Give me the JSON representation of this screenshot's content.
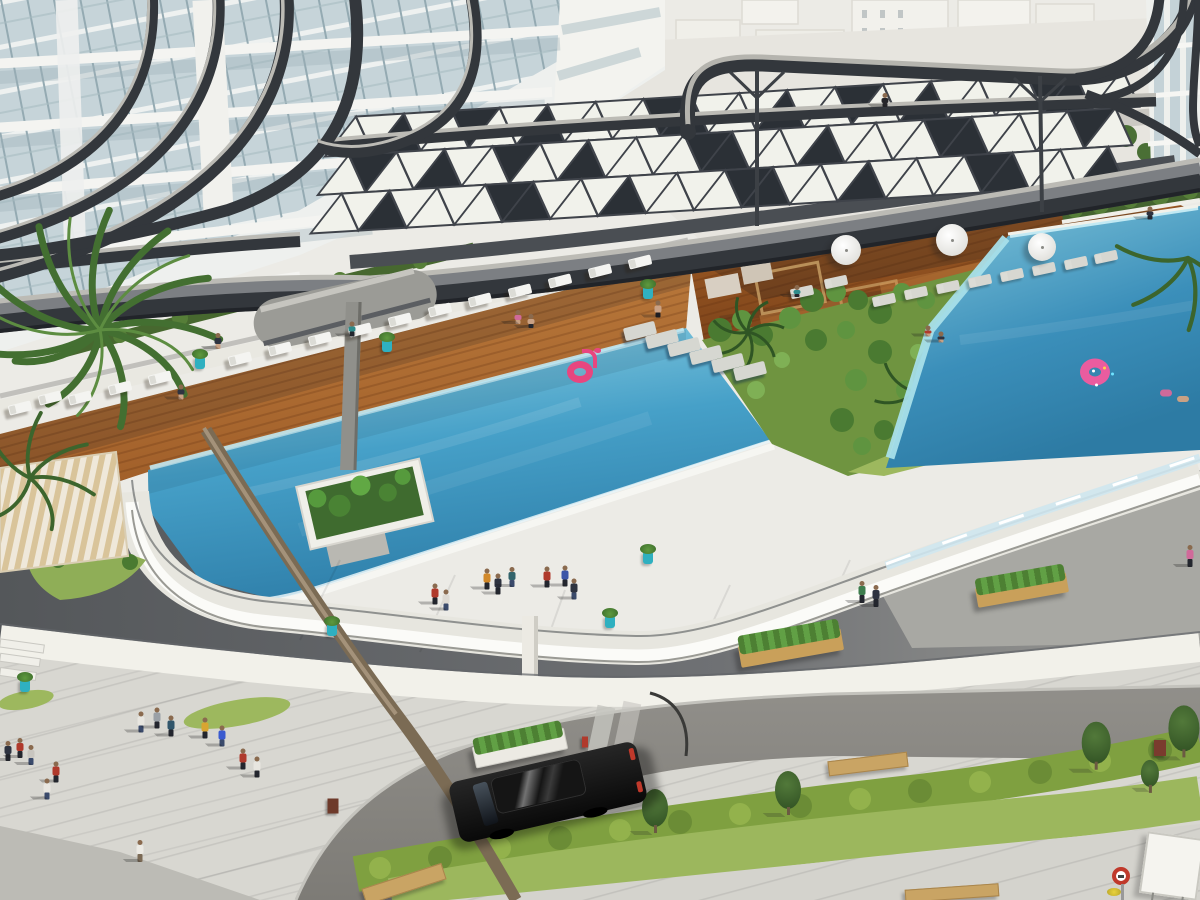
{
  "scene": {
    "name": "aerial-resort-pool-render",
    "width": 1200,
    "height": 900,
    "description": "3D architectural rendering, aerial view of residential complex with curved canopy, two pools, decks, plaza, street"
  },
  "palette": {
    "bg": "#ecebe6",
    "teal": "#2fb0c0",
    "pink": "#e8467f",
    "water-main": "#3f9ec7",
    "water-deep": "#2b7aa8",
    "water-shallow": "#9fdbe8",
    "fin-dark": "#33373c",
    "fin-light": "#bcbbb5",
    "panel-white": "#f1f2eb",
    "panel-dark": "#2b3036",
    "wood-deck": "#c08040",
    "wood-shade": "#8a4d20",
    "concrete": "#e9e8e1",
    "fascia": "#fbfbf8",
    "plaza-dark": "#54575a",
    "sidewalk": "#d8d7d1",
    "road": "#8e8c87",
    "hedge": "#7fa040",
    "grass": "#9cb75d",
    "palm": "#436f31",
    "trunk": "#7b6b54",
    "car": "#0a0a0a",
    "bench": "#c9a464",
    "sign-red": "#c0392b"
  },
  "canopy_field": {
    "cols": 17,
    "rows": 3,
    "cell_w": 48,
    "cell_h": 38,
    "dark": [
      [
        1,
        0,
        0
      ],
      [
        2,
        0,
        1
      ],
      [
        4,
        0,
        0
      ],
      [
        6,
        0,
        1
      ],
      [
        7,
        0,
        0
      ],
      [
        9,
        0,
        0
      ],
      [
        10,
        0,
        1
      ],
      [
        12,
        0,
        0
      ],
      [
        14,
        0,
        1
      ],
      [
        15,
        0,
        0
      ],
      [
        0,
        1,
        1
      ],
      [
        2,
        1,
        0
      ],
      [
        3,
        1,
        1
      ],
      [
        5,
        1,
        0
      ],
      [
        7,
        1,
        1
      ],
      [
        8,
        1,
        0
      ],
      [
        10,
        1,
        0
      ],
      [
        12,
        1,
        1
      ],
      [
        13,
        1,
        0
      ],
      [
        15,
        1,
        1
      ],
      [
        1,
        2,
        0
      ],
      [
        3,
        2,
        1
      ],
      [
        4,
        2,
        0
      ],
      [
        6,
        2,
        0
      ],
      [
        8,
        2,
        1
      ],
      [
        9,
        2,
        0
      ],
      [
        11,
        2,
        0
      ],
      [
        13,
        2,
        1
      ],
      [
        14,
        2,
        0
      ],
      [
        16,
        2,
        0
      ]
    ]
  },
  "items": {
    "people": [
      {
        "x": 435,
        "y": 594,
        "c": "#b03a2c",
        "p": "#23262e",
        "h": 21
      },
      {
        "x": 446,
        "y": 600,
        "c": "#ddd9d2",
        "p": "#3a4a6b",
        "h": 21
      },
      {
        "x": 487,
        "y": 579,
        "c": "#d2892a",
        "p": "#23262e",
        "h": 21
      },
      {
        "x": 498,
        "y": 584,
        "c": "#2e3340",
        "p": "#23262e",
        "h": 21
      },
      {
        "x": 512,
        "y": 577,
        "c": "#32636b",
        "p": "#3a4a6b",
        "h": 20
      },
      {
        "x": 547,
        "y": 577,
        "c": "#b03a2c",
        "p": "#23262e",
        "h": 21
      },
      {
        "x": 565,
        "y": 576,
        "c": "#3b55a8",
        "p": "#23262e",
        "h": 21
      },
      {
        "x": 574,
        "y": 589,
        "c": "#2e3340",
        "p": "#3a4a6b",
        "h": 21
      },
      {
        "x": 862,
        "y": 592,
        "c": "#3e7d4e",
        "p": "#23262e",
        "h": 22
      },
      {
        "x": 876,
        "y": 596,
        "c": "#2e3340",
        "p": "#23262e",
        "h": 22
      },
      {
        "x": 1190,
        "y": 556,
        "c": "#d06a9a",
        "p": "#23262e",
        "h": 22
      },
      {
        "x": 658,
        "y": 309,
        "c": "#c9a184",
        "p": "#1d1d22",
        "h": 17
      },
      {
        "x": 141,
        "y": 722,
        "c": "#e8e6e0",
        "p": "#3a4a6b",
        "h": 21
      },
      {
        "x": 157,
        "y": 718,
        "c": "#9aa0a6",
        "p": "#23262e",
        "h": 21
      },
      {
        "x": 171,
        "y": 726,
        "c": "#31566b",
        "p": "#23262e",
        "h": 21
      },
      {
        "x": 8,
        "y": 751,
        "c": "#2e3340",
        "p": "#23262e",
        "h": 20
      },
      {
        "x": 20,
        "y": 748,
        "c": "#b03a2c",
        "p": "#23262e",
        "h": 20
      },
      {
        "x": 31,
        "y": 755,
        "c": "#c8c5bf",
        "p": "#3a4a6b",
        "h": 20
      },
      {
        "x": 56,
        "y": 772,
        "c": "#b03a2c",
        "p": "#23262e",
        "h": 21
      },
      {
        "x": 47,
        "y": 789,
        "c": "#e8e6e0",
        "p": "#3a4a6b",
        "h": 21
      },
      {
        "x": 205,
        "y": 728,
        "c": "#d9a531",
        "p": "#23262e",
        "h": 21
      },
      {
        "x": 222,
        "y": 736,
        "c": "#3b5bd0",
        "p": "#3a4a6b",
        "h": 21
      },
      {
        "x": 243,
        "y": 759,
        "c": "#b03a2c",
        "p": "#23262e",
        "h": 21
      },
      {
        "x": 257,
        "y": 767,
        "c": "#e8e6e0",
        "p": "#23262e",
        "h": 21
      },
      {
        "x": 140,
        "y": 851,
        "c": "#eceae4",
        "p": "#7b6a55",
        "h": 22
      },
      {
        "x": 218,
        "y": 341,
        "c": "#2e3340",
        "p": "#c9a184",
        "h": 16
      },
      {
        "x": 181,
        "y": 392,
        "c": "#2e3340",
        "p": "#c9a184",
        "h": 15
      },
      {
        "x": 352,
        "y": 329,
        "c": "#2e8b8b",
        "p": "#23262e",
        "h": 15
      },
      {
        "x": 518,
        "y": 317,
        "c": "#d06a9a",
        "p": "#c9a184",
        "h": 14
      },
      {
        "x": 531,
        "y": 321,
        "c": "#c9a184",
        "p": "#23262e",
        "h": 14
      },
      {
        "x": 797,
        "y": 291,
        "c": "#2e8b8b",
        "p": "#23262e",
        "h": 12
      },
      {
        "x": 928,
        "y": 331,
        "c": "#b03a2c",
        "p": "#c9a184",
        "h": 11
      },
      {
        "x": 941,
        "y": 337,
        "c": "#2e3340",
        "p": "#c9a184",
        "h": 11
      },
      {
        "x": 1150,
        "y": 213,
        "c": "#2e3340",
        "p": "#23262e",
        "h": 13
      },
      {
        "x": 885,
        "y": 100,
        "c": "#26262a",
        "p": "#26262a",
        "h": 14
      },
      {
        "x": 1166,
        "y": 393,
        "c": "#d06a9a",
        "h": 7,
        "s": "swim"
      },
      {
        "x": 1183,
        "y": 399,
        "c": "#c9a184",
        "h": 6,
        "s": "swim"
      }
    ],
    "loungers": [
      {
        "x": 20,
        "y": 408,
        "a": -14
      },
      {
        "x": 50,
        "y": 398,
        "a": -14
      },
      {
        "x": 80,
        "y": 398,
        "a": -14
      },
      {
        "x": 120,
        "y": 388,
        "a": -14
      },
      {
        "x": 160,
        "y": 378,
        "a": -14
      },
      {
        "x": 240,
        "y": 359,
        "a": -14
      },
      {
        "x": 280,
        "y": 349,
        "a": -14
      },
      {
        "x": 320,
        "y": 339,
        "a": -14
      },
      {
        "x": 360,
        "y": 330,
        "a": -14
      },
      {
        "x": 400,
        "y": 320,
        "a": -14
      },
      {
        "x": 440,
        "y": 310,
        "a": -14
      },
      {
        "x": 480,
        "y": 300,
        "a": -14
      },
      {
        "x": 520,
        "y": 291,
        "a": -14
      },
      {
        "x": 560,
        "y": 281,
        "a": -14
      },
      {
        "x": 600,
        "y": 271,
        "a": -14
      },
      {
        "x": 640,
        "y": 262,
        "a": -14
      },
      {
        "x": 884,
        "y": 300,
        "a": -12,
        "shade": true
      },
      {
        "x": 916,
        "y": 293,
        "a": -12,
        "shade": true
      },
      {
        "x": 948,
        "y": 287,
        "a": -12,
        "shade": true
      },
      {
        "x": 980,
        "y": 281,
        "a": -12,
        "shade": true
      },
      {
        "x": 1012,
        "y": 275,
        "a": -12,
        "shade": true
      },
      {
        "x": 1044,
        "y": 269,
        "a": -12,
        "shade": true
      },
      {
        "x": 1076,
        "y": 263,
        "a": -12,
        "shade": true
      },
      {
        "x": 1106,
        "y": 257,
        "a": -12,
        "shade": true
      },
      {
        "x": 836,
        "y": 282,
        "a": -12,
        "shade": true
      },
      {
        "x": 802,
        "y": 292,
        "a": -12,
        "shade": true
      }
    ],
    "pots": [
      {
        "x": 200,
        "y": 363
      },
      {
        "x": 387,
        "y": 346
      },
      {
        "x": 648,
        "y": 293
      },
      {
        "x": 332,
        "y": 630
      },
      {
        "x": 610,
        "y": 622
      },
      {
        "x": 648,
        "y": 558
      },
      {
        "x": 25,
        "y": 686
      }
    ],
    "umbrellas": [
      {
        "x": 846,
        "y": 250,
        "r": 15
      },
      {
        "x": 952,
        "y": 240,
        "r": 16
      },
      {
        "x": 1042,
        "y": 247,
        "r": 14
      }
    ],
    "stones": [
      {
        "x": 640,
        "y": 331
      },
      {
        "x": 662,
        "y": 339
      },
      {
        "x": 684,
        "y": 347
      },
      {
        "x": 706,
        "y": 355
      },
      {
        "x": 728,
        "y": 363
      },
      {
        "x": 750,
        "y": 371
      }
    ],
    "floats": [
      {
        "type": "flamingo",
        "x": 580,
        "y": 372
      },
      {
        "type": "donut",
        "x": 1095,
        "y": 372
      }
    ],
    "trees": [
      {
        "x": 655,
        "y": 812,
        "k": 1
      },
      {
        "x": 788,
        "y": 794,
        "k": 1
      },
      {
        "x": 1096,
        "y": 747,
        "k": 1.1
      },
      {
        "x": 1184,
        "y": 733,
        "k": 1.2
      },
      {
        "x": 1150,
        "y": 776,
        "k": 0.7
      }
    ],
    "planter_boxes": [
      {
        "x": 791,
        "y": 648,
        "w": 104,
        "h": 22,
        "a": -10
      },
      {
        "x": 1022,
        "y": 590,
        "w": 92,
        "h": 20,
        "a": -10
      },
      {
        "x": 520,
        "y": 748,
        "w": 92,
        "h": 20,
        "a": -12,
        "white": true
      }
    ],
    "benches": [
      {
        "x": 404,
        "y": 884,
        "w": 82,
        "h": 15,
        "a": -18
      },
      {
        "x": 952,
        "y": 893,
        "w": 92,
        "h": 11,
        "a": -4
      },
      {
        "x": 868,
        "y": 764,
        "w": 78,
        "h": 13,
        "a": -7
      }
    ],
    "bins": [
      {
        "x": 333,
        "y": 806,
        "w": 11,
        "h": 15,
        "c": "#6e3a2a"
      },
      {
        "x": 1160,
        "y": 748,
        "w": 12,
        "h": 16,
        "c": "#7a3b2e"
      },
      {
        "x": 585,
        "y": 742,
        "w": 6,
        "h": 11,
        "c": "#b03a2c"
      }
    ],
    "car": {
      "x": 548,
      "y": 792,
      "w": 192,
      "h": 62,
      "a": -13
    },
    "signs": {
      "circle": {
        "x": 1121,
        "y": 876,
        "d": 18
      },
      "board": {
        "x": 1172,
        "y": 866,
        "w": 54,
        "h": 58,
        "a": 8
      },
      "flowers": {
        "x": 1114,
        "y": 892,
        "w": 14,
        "h": 8
      }
    }
  }
}
